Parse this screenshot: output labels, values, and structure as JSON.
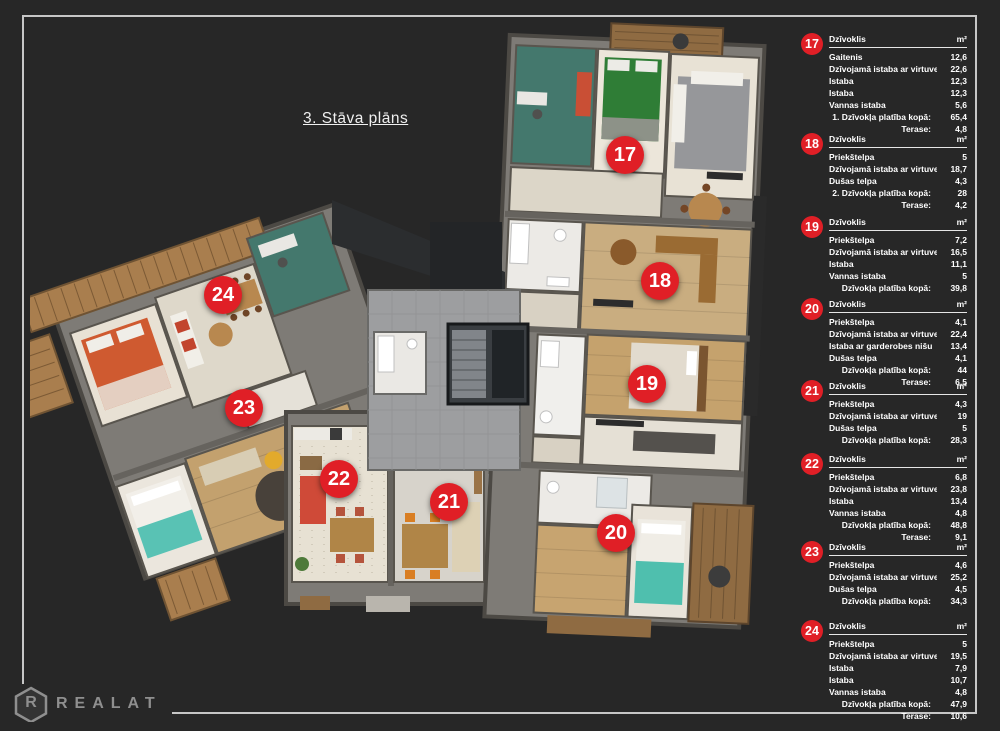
{
  "page": {
    "title": "3. Stāva plāns",
    "background": "#272727",
    "accent_red": "#e01f26",
    "frame_color": "#c6c6c6",
    "logo_gray": "#8f8f8f"
  },
  "brand": {
    "logo_letter": "R",
    "logo_text": "REALAT"
  },
  "legend": {
    "header_label": "Dzīvoklis",
    "header_unit": "m²",
    "apartments": [
      {
        "number": "17",
        "rows": [
          {
            "label": "Gaitenis",
            "value": "12,6"
          },
          {
            "label": "Dzīvojamā istaba ar virtuves nišu",
            "value": "22,6"
          },
          {
            "label": "Istaba",
            "value": "12,3"
          },
          {
            "label": "Istaba",
            "value": "12,3"
          },
          {
            "label": "Vannas istaba",
            "value": "5,6"
          }
        ],
        "totals": [
          {
            "label": "1. Dzīvokļa platība kopā:",
            "value": "65,4"
          },
          {
            "label": "Terase:",
            "value": "4,8"
          }
        ]
      },
      {
        "number": "18",
        "rows": [
          {
            "label": "Priekštelpa",
            "value": "5"
          },
          {
            "label": "Dzīvojamā istaba ar virtuves zonu",
            "value": "18,7"
          },
          {
            "label": "Dušas telpa",
            "value": "4,3"
          }
        ],
        "totals": [
          {
            "label": "2. Dzīvokļa platība kopā:",
            "value": "28"
          },
          {
            "label": "Terase:",
            "value": "4,2"
          }
        ]
      },
      {
        "number": "19",
        "rows": [
          {
            "label": "Priekštelpa",
            "value": "7,2"
          },
          {
            "label": "Dzīvojamā istaba ar virtuves zonu",
            "value": "16,5"
          },
          {
            "label": "Istaba",
            "value": "11,1"
          },
          {
            "label": "Vannas istaba",
            "value": "5"
          }
        ],
        "totals": [
          {
            "label": "Dzīvokļa platība kopā:",
            "value": "39,8"
          }
        ]
      },
      {
        "number": "20",
        "rows": [
          {
            "label": "Priekštelpa",
            "value": "4,1"
          },
          {
            "label": "Dzīvojamā istaba ar virtuves nišu",
            "value": "22,4"
          },
          {
            "label": "Istaba ar garderobes nišu",
            "value": "13,4"
          },
          {
            "label": "Dušas telpa",
            "value": "4,1"
          }
        ],
        "totals": [
          {
            "label": "Dzīvokļa platība kopā:",
            "value": "44"
          },
          {
            "label": "Terase:",
            "value": "6,5"
          }
        ]
      },
      {
        "number": "21",
        "rows": [
          {
            "label": "Priekštelpa",
            "value": "4,3"
          },
          {
            "label": "Dzīvojamā istaba ar virtuves zonu",
            "value": "19"
          },
          {
            "label": "Dušas telpa",
            "value": "5"
          }
        ],
        "totals": [
          {
            "label": "Dzīvokļa platība kopā:",
            "value": "28,3"
          }
        ]
      },
      {
        "number": "22",
        "rows": [
          {
            "label": "Priekštelpa",
            "value": "6,8"
          },
          {
            "label": "Dzīvojamā istaba ar virtuves zonu",
            "value": "23,8"
          },
          {
            "label": "Istaba",
            "value": "13,4"
          },
          {
            "label": "Vannas istaba",
            "value": "4,8"
          }
        ],
        "totals": [
          {
            "label": "Dzīvokļa platība kopā:",
            "value": "48,8"
          },
          {
            "label": "Terase:",
            "value": "9,1"
          }
        ]
      },
      {
        "number": "23",
        "rows": [
          {
            "label": "Priekštelpa",
            "value": "4,6"
          },
          {
            "label": "Dzīvojamā istaba ar virtuves zonu",
            "value": "25,2"
          },
          {
            "label": "Dušas telpa",
            "value": "4,5"
          }
        ],
        "totals": [
          {
            "label": "Dzīvokļa platība kopā:",
            "value": "34,3"
          }
        ]
      },
      {
        "number": "24",
        "rows": [
          {
            "label": "Priekštelpa",
            "value": "5"
          },
          {
            "label": "Dzīvojamā istaba ar virtuves zonu",
            "value": "19,5"
          },
          {
            "label": "Istaba",
            "value": "7,9"
          },
          {
            "label": "Istaba",
            "value": "10,7"
          },
          {
            "label": "Vannas istaba",
            "value": "4,8"
          }
        ],
        "totals": [
          {
            "label": "Dzīvokļa platība kopā:",
            "value": "47,9"
          },
          {
            "label": "Terase:",
            "value": "10,6"
          }
        ]
      }
    ]
  }
}
